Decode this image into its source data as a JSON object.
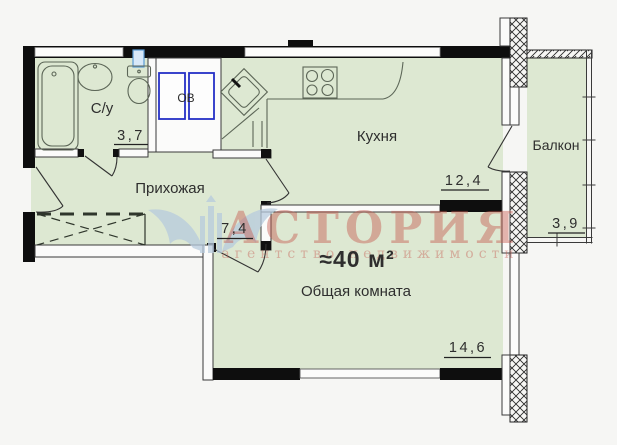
{
  "plan": {
    "total_area": "≈40 м²",
    "rooms": {
      "bathroom": {
        "label": "С/у",
        "area": "3,7"
      },
      "utility": {
        "label": "ОВ"
      },
      "hallway": {
        "label": "Прихожая",
        "area": "7,4"
      },
      "kitchen": {
        "label": "Кухня",
        "area": "12,4"
      },
      "living": {
        "label": "Общая комната",
        "area": "14,6"
      },
      "balcony": {
        "label": "Балкон",
        "area": "3,9"
      }
    }
  },
  "watermark": {
    "brand": "АСТОРИЯ",
    "tagline": "агентство недвижимости"
  },
  "colors": {
    "room_fill": "#dde8d2",
    "wall_black": "#0e0e0e",
    "thin_line": "#3a3a3a",
    "fixture_line": "#5c6657",
    "accent_blue": "#2530c6",
    "pipe_blue": "#5b9bd5",
    "watermark_red": "#c65a50",
    "watermark_blue": "#b7cbdd"
  }
}
